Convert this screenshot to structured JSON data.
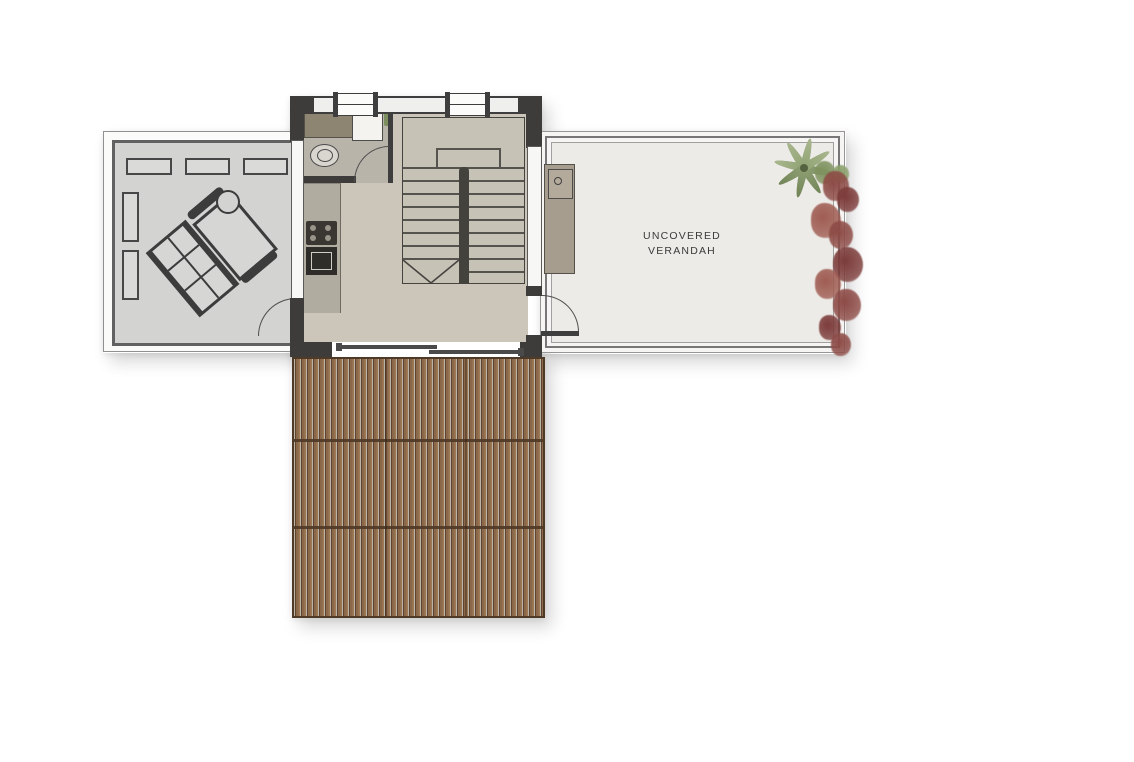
{
  "plan": {
    "type": "floor-plan",
    "verandah": {
      "label_line1": "UNCOVERED",
      "label_line2": "VERANDAH"
    },
    "rooms": [
      "covered-terrace-lounge",
      "bathroom",
      "kitchen",
      "stair-hall",
      "uncovered-verandah",
      "pergola-deck"
    ],
    "fixtures": [
      "toilet",
      "bathroom-sink",
      "stove",
      "oven",
      "kitchen-counter",
      "staircase",
      "sliding-door",
      "swing-doors",
      "outdoor-bbq-unit",
      "dining-set",
      "round-side-table",
      "bench-cushions"
    ],
    "plants": [
      "palm-tree",
      "bougainvillea"
    ]
  },
  "colors": {
    "wall": "#3d3c3b",
    "floor_beige": "#cbc6b9",
    "floor_gray": "#d3d3d2",
    "bathroom_floor": "#b8b4aa",
    "stair_floor": "#c7c2b6",
    "verandah_floor": "#edebe7",
    "counter_olive": "#8d8471",
    "kitchen_counter": "#b1aca0",
    "pergola_dark": "#5e4430",
    "pergola_mid": "#8b684a",
    "pergola_light": "#9d7a55",
    "pergola_gap": "#bdb4a8",
    "pergola_frame": "#4f3a27",
    "palm_green": "#93a577",
    "palm_dark": "#6d8054",
    "flower_red": "#8d4b46",
    "flower_dark": "#7c3c3a",
    "flower_light": "#9f5c52",
    "leaf_green": "#7f935f"
  },
  "stairs": {
    "left_tread_count": 7,
    "right_tread_count": 8
  },
  "pergola": {
    "rows": 3,
    "cols": 3
  },
  "palm": {
    "leaf_count": 8
  },
  "bougainvillea_blobs": [
    [
      12,
      -8,
      20,
      "#7f935f"
    ],
    [
      30,
      -4,
      16,
      "#8ba06b"
    ],
    [
      20,
      2,
      26,
      "#8d4b46"
    ],
    [
      34,
      18,
      22,
      "#7c3c3a"
    ],
    [
      8,
      34,
      30,
      "#9f5c52"
    ],
    [
      26,
      52,
      24,
      "#8d4b46"
    ],
    [
      30,
      78,
      30,
      "#7c3c3a"
    ],
    [
      12,
      100,
      26,
      "#9f5c52"
    ],
    [
      30,
      120,
      28,
      "#8d4b46"
    ],
    [
      16,
      146,
      22,
      "#7c3c3a"
    ],
    [
      28,
      164,
      20,
      "#8d4b46"
    ]
  ]
}
